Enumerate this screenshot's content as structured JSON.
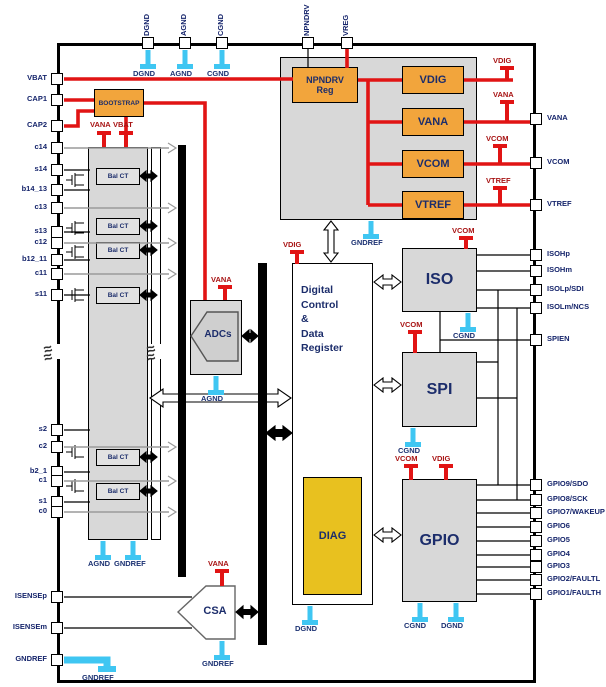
{
  "diagram": {
    "break_symbol": "≈",
    "pins": {
      "top": [
        "DGND",
        "AGND",
        "CGND",
        "NPNDRV",
        "VREG"
      ],
      "left": [
        "VBAT",
        "CAP1",
        "CAP2",
        "c14",
        "s14",
        "b14_13",
        "c13",
        "s13",
        "c12",
        "b12_11",
        "c11",
        "s11",
        "s2",
        "c2",
        "b2_1",
        "c1",
        "s1",
        "c0",
        "ISENSEp",
        "ISENSEm",
        "GNDREF"
      ],
      "right": [
        "VANA",
        "VCOM",
        "VTREF",
        "ISOHp",
        "ISOHm",
        "ISOLp/SDI",
        "ISOLm/NCS",
        "SPIEN",
        "GPIO9/SDO",
        "GPIO8/SCK",
        "GPIO7/WAKEUP",
        "GPIO6",
        "GPIO5",
        "GPIO4",
        "GPIO3",
        "GPIO2/FAULTL",
        "GPIO1/FAULTH"
      ]
    },
    "blocks": {
      "bootstrap": "BOOTSTRAP",
      "npndrv_line1": "NPNDRV",
      "npndrv_line2": "Reg",
      "reg_blocks": [
        "VDIG",
        "VANA",
        "VCOM",
        "VTREF"
      ],
      "balct": "Bal CT",
      "adcs": "ADCs",
      "digital_lines": [
        "Digital",
        "Control",
        "&",
        "Data",
        "Register"
      ],
      "diag": "DIAG",
      "iso": "ISO",
      "spi": "SPI",
      "gpio": "GPIO",
      "csa": "CSA"
    },
    "supplies": [
      "VANA",
      "VBAT",
      "VANA",
      "VDIG",
      "VCOM",
      "VCOM",
      "VCOM",
      "VDIG",
      "VANA",
      "VDIG",
      "VANA",
      "VCOM",
      "VTREF"
    ],
    "grounds": [
      "DGND",
      "AGND",
      "CGND",
      "GNDREF",
      "CGND",
      "CGND",
      "CGND",
      "DGND",
      "DGND",
      "AGND",
      "AGND",
      "GNDREF",
      "GNDREF",
      "GNDREF"
    ],
    "colors": {
      "orange_block": "#f2a53c",
      "gold_block": "#e8c11f",
      "gray_block": "#d8d8d8",
      "supply_red": "#e11414",
      "ground_cyan": "#3fc6f2",
      "label_navy": "#15246b",
      "supply_label_red": "#a81414"
    }
  }
}
